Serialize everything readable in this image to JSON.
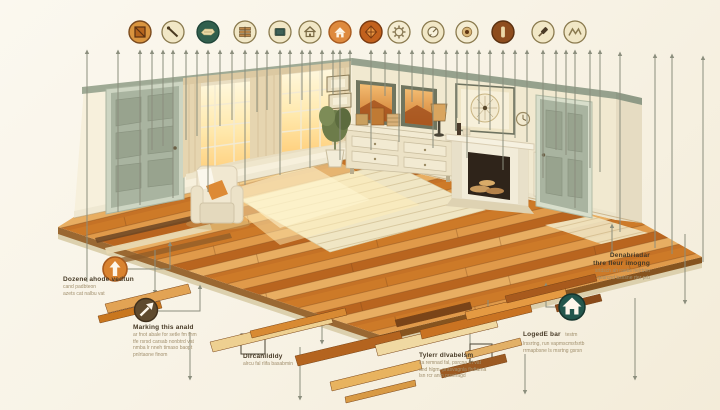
{
  "palette": {
    "bg": "#f8f3e6",
    "bg_hi": "#fbf8ef",
    "bg_lo": "#f3ecd9",
    "line": "#8b8e7d",
    "ink": "#473a26",
    "ink_soft": "#a2906e",
    "orange": "#d9822f",
    "dark_orange": "#c2611d",
    "teal": "#23564c",
    "brown": "#5f4a2e",
    "sage": "#9faa95",
    "wall_left": "#f7f0dc",
    "wall_right": "#f1e9d0",
    "wood_dark": "#8a4a1a",
    "wood_mid": "#d1812f",
    "wood_light": "#e8b35f",
    "underlay": "#f0e6c4"
  },
  "icons": [
    {
      "name": "framed-board-icon",
      "fill": "#d9953f"
    },
    {
      "name": "nail-icon",
      "fill": "#f1e7c6"
    },
    {
      "name": "plane-tool-icon",
      "fill": "#315f4d"
    },
    {
      "name": "plank-stack-icon",
      "fill": "#f1e7c6"
    },
    {
      "name": "screen-icon",
      "fill": "#f1e7c6"
    },
    {
      "name": "home-outline-icon",
      "fill": "#f1e7c6"
    },
    {
      "name": "home-filled-icon",
      "fill": "#de8a3e"
    },
    {
      "name": "diamond-icon",
      "fill": "#c2611d"
    },
    {
      "name": "gear-icon",
      "fill": "#f4ecd2"
    },
    {
      "name": "gauge-icon",
      "fill": "#f1e7c6"
    },
    {
      "name": "wood-knot-icon",
      "fill": "#f4ecd2"
    },
    {
      "name": "plank-end-icon",
      "fill": "#8e4d1e"
    },
    {
      "name": "mallet-icon",
      "fill": "#f1e7c6"
    },
    {
      "name": "grain-zigzag-icon",
      "fill": "#f1e7c6"
    }
  ],
  "badges": [
    {
      "name": "install-direction-badge",
      "fill": "#d9822f"
    },
    {
      "name": "marking-arrow-badge",
      "fill": "#5f4a2e"
    },
    {
      "name": "home-badge",
      "fill": "#23564c"
    }
  ],
  "callouts": {
    "install": {
      "title": "Dozene ahode vedtun",
      "line1": "cand padbteon",
      "line2": "azets cat nalbu vat"
    },
    "marking": {
      "title": "Marking this anald",
      "line1": "ar fnot abale for setle fm fnm",
      "line2": "tfe rsrsd carsab nonbtrd vat",
      "line3": "nmba lr nneh timaso baopt",
      "line4": "pnlrtaone finom"
    },
    "disassembly": {
      "title": "Dircanildldy",
      "line1": "alrcu fal rlifa basabmin"
    },
    "tyler": {
      "title": "Tylerr dlvabelsm",
      "line1": "ca remnad fal, psrcna frt vat",
      "line2": "and hlgm, prasvagnla flrdtama",
      "line3": "lsn rcr anm prschagd"
    },
    "underlay": {
      "title1": "Denabriadar",
      "title2": "thre fleur imogng",
      "line1": "srtdsch ah raebs nelrbtm",
      "line2": "qesrcnd bsrlsne rter prb"
    },
    "legend": {
      "title": "LogedE bar",
      "suffix": "testm",
      "line1": "lrssrtng, run vapmscmsfsrtb",
      "line2": "rrmapbsne ls msrtng gsrsn"
    }
  }
}
